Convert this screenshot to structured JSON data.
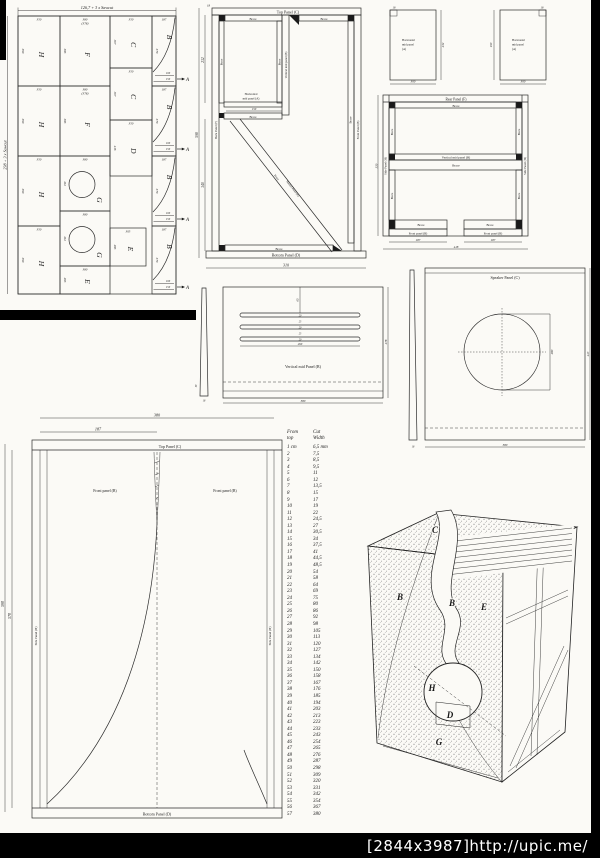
{
  "watermark": {
    "text": "[2844x3987]http://upic.me/"
  },
  "cutting": {
    "top_dim": "126,7 + 3 x Sawcut",
    "left_dim": "238 + 3 x Sawcut",
    "arrow": {
      "letter": "A",
      "dims": [
        "100",
        "150"
      ]
    },
    "panels": [
      {
        "letter": "H",
        "top": "350",
        "left": "590",
        "x": 14,
        "y": 14,
        "w": 42,
        "h": 70
      },
      {
        "letter": "H",
        "top": "350",
        "left": "590",
        "x": 14,
        "y": 84,
        "w": 42,
        "h": 70
      },
      {
        "letter": "H",
        "top": "350",
        "left": "590",
        "x": 14,
        "y": 154,
        "w": 42,
        "h": 70
      },
      {
        "letter": "H",
        "top": "350",
        "left": "590",
        "x": 14,
        "y": 224,
        "w": 42,
        "h": 68
      },
      {
        "letter": "F",
        "top": "380",
        "top2": "(378)",
        "left": "585",
        "x": 56,
        "y": 14,
        "w": 50,
        "h": 70
      },
      {
        "letter": "F",
        "top": "380",
        "top2": "(378)",
        "left": "585",
        "x": 56,
        "y": 84,
        "w": 50,
        "h": 70
      },
      {
        "letter": "G",
        "top": "380",
        "left": "412",
        "x": 56,
        "y": 154,
        "w": 50,
        "h": 55,
        "circle": true
      },
      {
        "letter": "G",
        "top": "380",
        "left": "412",
        "x": 56,
        "y": 209,
        "w": 50,
        "h": 55,
        "circle": true
      },
      {
        "letter": "E",
        "top": "380",
        "left": "265",
        "x": 56,
        "y": 264,
        "w": 50,
        "h": 28
      },
      {
        "letter": "C",
        "top": "350",
        "left": "307",
        "x": 106,
        "y": 14,
        "w": 42,
        "h": 52
      },
      {
        "letter": "C",
        "top": "350",
        "left": "307",
        "x": 106,
        "y": 66,
        "w": 42,
        "h": 52
      },
      {
        "letter": "D",
        "top": "350",
        "left": "416",
        "x": 106,
        "y": 118,
        "w": 42,
        "h": 56
      },
      {
        "letter": "E",
        "top": "305",
        "left": "285",
        "x": 106,
        "y": 226,
        "w": 36,
        "h": 38
      },
      {
        "letter": "B",
        "top": "187",
        "left": "570",
        "x": 148,
        "y": 14,
        "w": 24,
        "h": 70,
        "curve": true,
        "arrow": true
      },
      {
        "letter": "B",
        "top": "187",
        "left": "570",
        "x": 148,
        "y": 84,
        "w": 24,
        "h": 70,
        "curve": true,
        "arrow": true
      },
      {
        "letter": "B",
        "top": "187",
        "left": "570",
        "x": 148,
        "y": 154,
        "w": 24,
        "h": 70,
        "curve": true,
        "arrow": true
      },
      {
        "letter": "B",
        "top": "187",
        "left": "570",
        "x": 148,
        "y": 224,
        "w": 24,
        "h": 68,
        "curve": true,
        "arrow": true
      }
    ]
  },
  "cross_section": {
    "top_panel": "Top Panel (C)",
    "bottom_panel": "Bottom Panel (D)",
    "back_panel": "Back Panel (F)",
    "front_panel": "Front Panel (B)",
    "vertical_mid": "Vertical mid panel (B)",
    "horizontal_mid_l1": "Horizontal",
    "horizontal_mid_l2": "mid panel (A)",
    "slanted_panel": "Slanted Panel (E)",
    "brace": "Brace",
    "dims": {
      "total_height": "598",
      "upper": "232",
      "lower": "340",
      "width": "310",
      "mid_width": "150",
      "thickness": "18"
    }
  },
  "h_mid_panels": {
    "l1": "Horizontal",
    "l2": "mid panel",
    "l3": "(A)",
    "panel1": {
      "height": "232",
      "width": "300",
      "notch": "18"
    },
    "panel2": {
      "height": "190",
      "width": "300",
      "notch": "18"
    }
  },
  "top_view": {
    "rear_panel": "Rear Panel (F)",
    "side_panel": "Side Panel (H)",
    "vertical_mid": "Vertical mid panel (B)",
    "front_panel": "Front panel (B)",
    "brace": "Brace",
    "dims": {
      "half_left": "187",
      "half_right": "187",
      "total": "418",
      "depth": "350"
    }
  },
  "vertical_mid_panel": {
    "label": "Vertical mid Panel (B)",
    "dims": {
      "width": "380",
      "height": "278",
      "slot_length": "260",
      "top_offset": "65",
      "slot_stack": [
        "20",
        "25",
        "20",
        "25",
        "20"
      ],
      "edge_a": "50",
      "edge_b": "18"
    }
  },
  "speaker_panel": {
    "label": "Speaker Panel (C)",
    "dims": {
      "width": "380",
      "height": "413",
      "cutout": "280",
      "edge": "18"
    }
  },
  "front_template": {
    "top_panel": "Top Panel (C)",
    "bottom_panel": "Bottom Panel (D)",
    "front_panel_left": "Front panel (B)",
    "front_panel_right": "Front panel (B)",
    "side_panel_left": "Side Panel (H)",
    "side_panel_right": "Side Panel (H)",
    "dims": {
      "total_width": "380",
      "half_width": "187",
      "outer_height": "590",
      "inner_height": "570"
    }
  },
  "cut_table": {
    "header_col1": "From\ntop",
    "header_col2": "Cut\nWidth",
    "rows": [
      [
        "1 cm",
        "6,5 mm"
      ],
      [
        "2",
        "7,5"
      ],
      [
        "3",
        "8,5"
      ],
      [
        "4",
        "9,5"
      ],
      [
        "5",
        "11"
      ],
      [
        "6",
        "12"
      ],
      [
        "7",
        "13,5"
      ],
      [
        "8",
        "15"
      ],
      [
        "9",
        "17"
      ],
      [
        "10",
        "19"
      ],
      [
        "11",
        "22"
      ],
      [
        "12",
        "24,5"
      ],
      [
        "13",
        "27"
      ],
      [
        "14",
        "30,5"
      ],
      [
        "15",
        "34"
      ],
      [
        "16",
        "37,5"
      ],
      [
        "17",
        "41"
      ],
      [
        "18",
        "44,5"
      ],
      [
        "19",
        "48,5"
      ],
      [
        "20",
        "54"
      ],
      [
        "21",
        "58"
      ],
      [
        "22",
        "64"
      ],
      [
        "23",
        "69"
      ],
      [
        "24",
        "75"
      ],
      [
        "25",
        "80"
      ],
      [
        "26",
        "86"
      ],
      [
        "27",
        "92"
      ],
      [
        "28",
        "98"
      ],
      [
        "29",
        "105"
      ],
      [
        "30",
        "113"
      ],
      [
        "31",
        "120"
      ],
      [
        "32",
        "127"
      ],
      [
        "33",
        "134"
      ],
      [
        "34",
        "142"
      ],
      [
        "35",
        "150"
      ],
      [
        "36",
        "158"
      ],
      [
        "37",
        "167"
      ],
      [
        "38",
        "176"
      ],
      [
        "39",
        "185"
      ],
      [
        "40",
        "194"
      ],
      [
        "41",
        "203"
      ],
      [
        "42",
        "213"
      ],
      [
        "43",
        "223"
      ],
      [
        "44",
        "233"
      ],
      [
        "45",
        "243"
      ],
      [
        "46",
        "254"
      ],
      [
        "47",
        "265"
      ],
      [
        "48",
        "276"
      ],
      [
        "49",
        "287"
      ],
      [
        "50",
        "298"
      ],
      [
        "51",
        "309"
      ],
      [
        "52",
        "320"
      ],
      [
        "53",
        "331"
      ],
      [
        "54",
        "342"
      ],
      [
        "55",
        "354"
      ],
      [
        "56",
        "367"
      ],
      [
        "57",
        "380"
      ]
    ]
  },
  "sketch": {
    "letters": [
      {
        "t": "C",
        "x": 77,
        "y": 35
      },
      {
        "t": "B",
        "x": 42,
        "y": 102
      },
      {
        "t": "B",
        "x": 94,
        "y": 108
      },
      {
        "t": "E",
        "x": 126,
        "y": 112
      },
      {
        "t": "H",
        "x": 74,
        "y": 193
      },
      {
        "t": "D",
        "x": 92,
        "y": 220
      },
      {
        "t": "G",
        "x": 81,
        "y": 247
      }
    ]
  }
}
